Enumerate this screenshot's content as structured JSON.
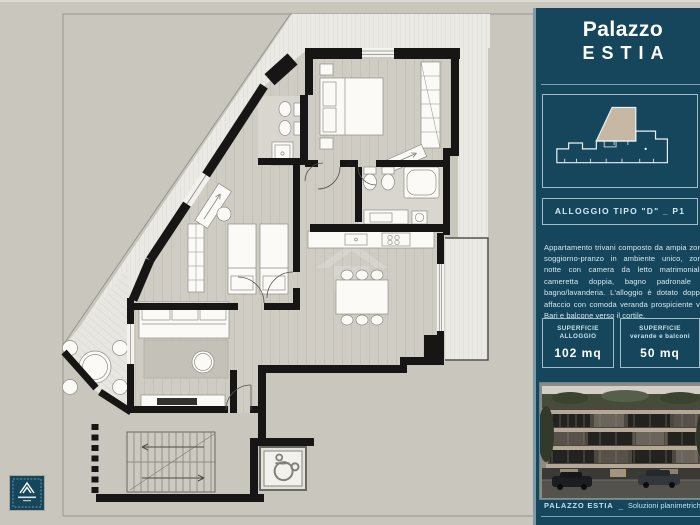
{
  "panel": {
    "title": {
      "line1": "Palazzo",
      "line2": "ESTIA"
    },
    "unit_box": {
      "label": "ALLOGGIO TIPO \"D\" _ P1"
    },
    "description": "Appartamento trivani composto da ampia zona soggiorno-pranzo in ambiente unico, zona notte con camera da letto matrimoniale, cameretta doppia, bagno padronale e bagno/lavanderia. L'alloggio è dotato doppio affaccio con comoda veranda prospiciente via Bari e balcone verso il cortile.",
    "stats": [
      {
        "label_top": "SUPERFICIE",
        "label_bottom": "ALLOGGIO",
        "value": "102 mq"
      },
      {
        "label_top": "SUPERFICIE",
        "label_bottom": "verande e balconi",
        "value": "50 mq"
      }
    ],
    "footer": {
      "brand": "PALAZZO ESTIA",
      "separator": "_",
      "text": "Soluzioni planimetriche"
    },
    "colors": {
      "panel_bg": "#16465c",
      "panel_edge": "#7e9aa8",
      "accent_text": "#cfeaf4",
      "title_text": "#ffffff",
      "unit_highlight_tan": "#c7b8a3"
    }
  },
  "plan": {
    "colors": {
      "background": "#c9c6bd",
      "walls": "#171614",
      "floor_planks": "#cfccc3",
      "veranda_floor": "#eae9e4",
      "site_line": "#98958d",
      "furniture": "#fbfaf7"
    },
    "icons": {
      "wheelchair-icon": "outline wheelchair glyph (accessible elevator)",
      "staircase-icon": "treads with direction arrows",
      "builder-logo": "peaked-A mark in teal square",
      "watermark-icon": "faint house glyph"
    }
  }
}
